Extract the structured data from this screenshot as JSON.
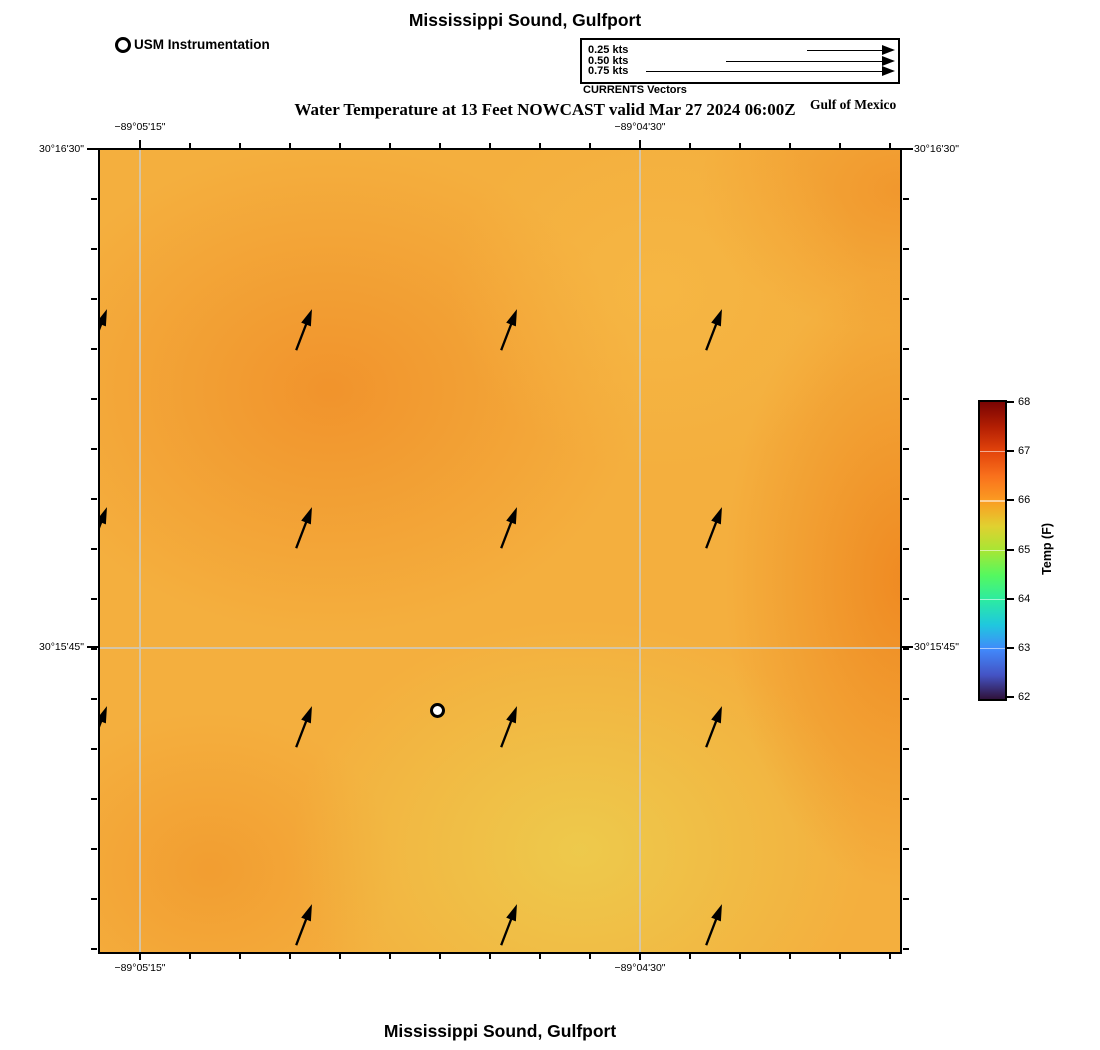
{
  "header": {
    "title": "Mississippi Sound, Gulfport",
    "subtitle": "Water Temperature at 13 Feet NOWCAST valid Mar 27 2024 06:00Z",
    "region_label": "Gulf of Mexico"
  },
  "legend": {
    "instrumentation_label": "USM Instrumentation",
    "currents": {
      "caption": "CURRENTS Vectors",
      "items": [
        {
          "label": "0.25 kts",
          "length_px": 85
        },
        {
          "label": "0.50 kts",
          "length_px": 166
        },
        {
          "label": "0.75 kts",
          "length_px": 246
        }
      ]
    }
  },
  "map": {
    "axis": {
      "top": [
        {
          "text": "−89°05'15\""
        },
        {
          "text": "−89°04'30\""
        }
      ],
      "bottom": [
        {
          "text": "−89°05'15\""
        },
        {
          "text": "−89°04'30\""
        }
      ],
      "left": [
        {
          "text": "30°16'30\""
        },
        {
          "text": "30°15'45\""
        }
      ],
      "right": [
        {
          "text": "30°16'30\""
        },
        {
          "text": "30°15'45\""
        }
      ]
    }
  },
  "colorbar_label": "Temp (F)",
  "footer": {
    "title": "Mississippi Sound, Gulfport"
  },
  "chart_data": {
    "type": "heatmap",
    "title": "Mississippi Sound, Gulfport",
    "subtitle": "Water Temperature at 13 Feet NOWCAST valid Mar 27 2024 06:00Z",
    "region": "Gulf of Mexico",
    "x_axis": {
      "label": "longitude",
      "tick_labels": [
        "−89°05'15\"",
        "−89°04'30\""
      ],
      "tick_positions_frac": [
        0.05,
        0.675
      ]
    },
    "y_axis": {
      "label": "latitude",
      "tick_labels": [
        "30°16'30\"",
        "30°15'45\""
      ],
      "tick_positions_frac": [
        0.0,
        0.62
      ]
    },
    "grid": true,
    "colorbar": {
      "label": "Temp (F)",
      "min": 62,
      "max": 68,
      "ticks": [
        68,
        67,
        66,
        65,
        64,
        63,
        62
      ],
      "colormap": "turbo",
      "stops_hex": [
        "#30123B",
        "#4189FB",
        "#1FC8DE",
        "#2CEBA2",
        "#A7E634",
        "#FB9C22",
        "#E3440B",
        "#7A0403"
      ]
    },
    "temperature_field_F": {
      "note": "approximate values read from colors on a 5x5 grid, row-major from NW corner",
      "grid": [
        [
          66.1,
          66.2,
          65.9,
          65.8,
          66.3
        ],
        [
          66.1,
          66.3,
          66.0,
          65.8,
          66.4
        ],
        [
          66.0,
          66.1,
          65.8,
          65.9,
          66.4
        ],
        [
          66.0,
          66.0,
          65.6,
          65.7,
          66.2
        ],
        [
          66.1,
          65.9,
          65.6,
          65.6,
          66.2
        ]
      ]
    },
    "current_vectors": {
      "legend_scale_kts": [
        0.25,
        0.5,
        0.75
      ],
      "approx_speed_kts": 0.12,
      "direction": "NNE",
      "positions_px": [
        {
          "x": 0,
          "y": 180,
          "clipped": true
        },
        {
          "x": 205,
          "y": 180
        },
        {
          "x": 410,
          "y": 180
        },
        {
          "x": 615,
          "y": 180
        },
        {
          "x": 0,
          "y": 378,
          "clipped": true
        },
        {
          "x": 205,
          "y": 378
        },
        {
          "x": 410,
          "y": 378
        },
        {
          "x": 615,
          "y": 378
        },
        {
          "x": 0,
          "y": 577,
          "clipped": true
        },
        {
          "x": 205,
          "y": 577
        },
        {
          "x": 410,
          "y": 577
        },
        {
          "x": 615,
          "y": 577
        },
        {
          "x": 205,
          "y": 775
        },
        {
          "x": 410,
          "y": 775
        },
        {
          "x": 615,
          "y": 775
        }
      ]
    },
    "station_marker": {
      "label": "USM Instrumentation",
      "x_px": 337,
      "y_px": 560
    }
  }
}
